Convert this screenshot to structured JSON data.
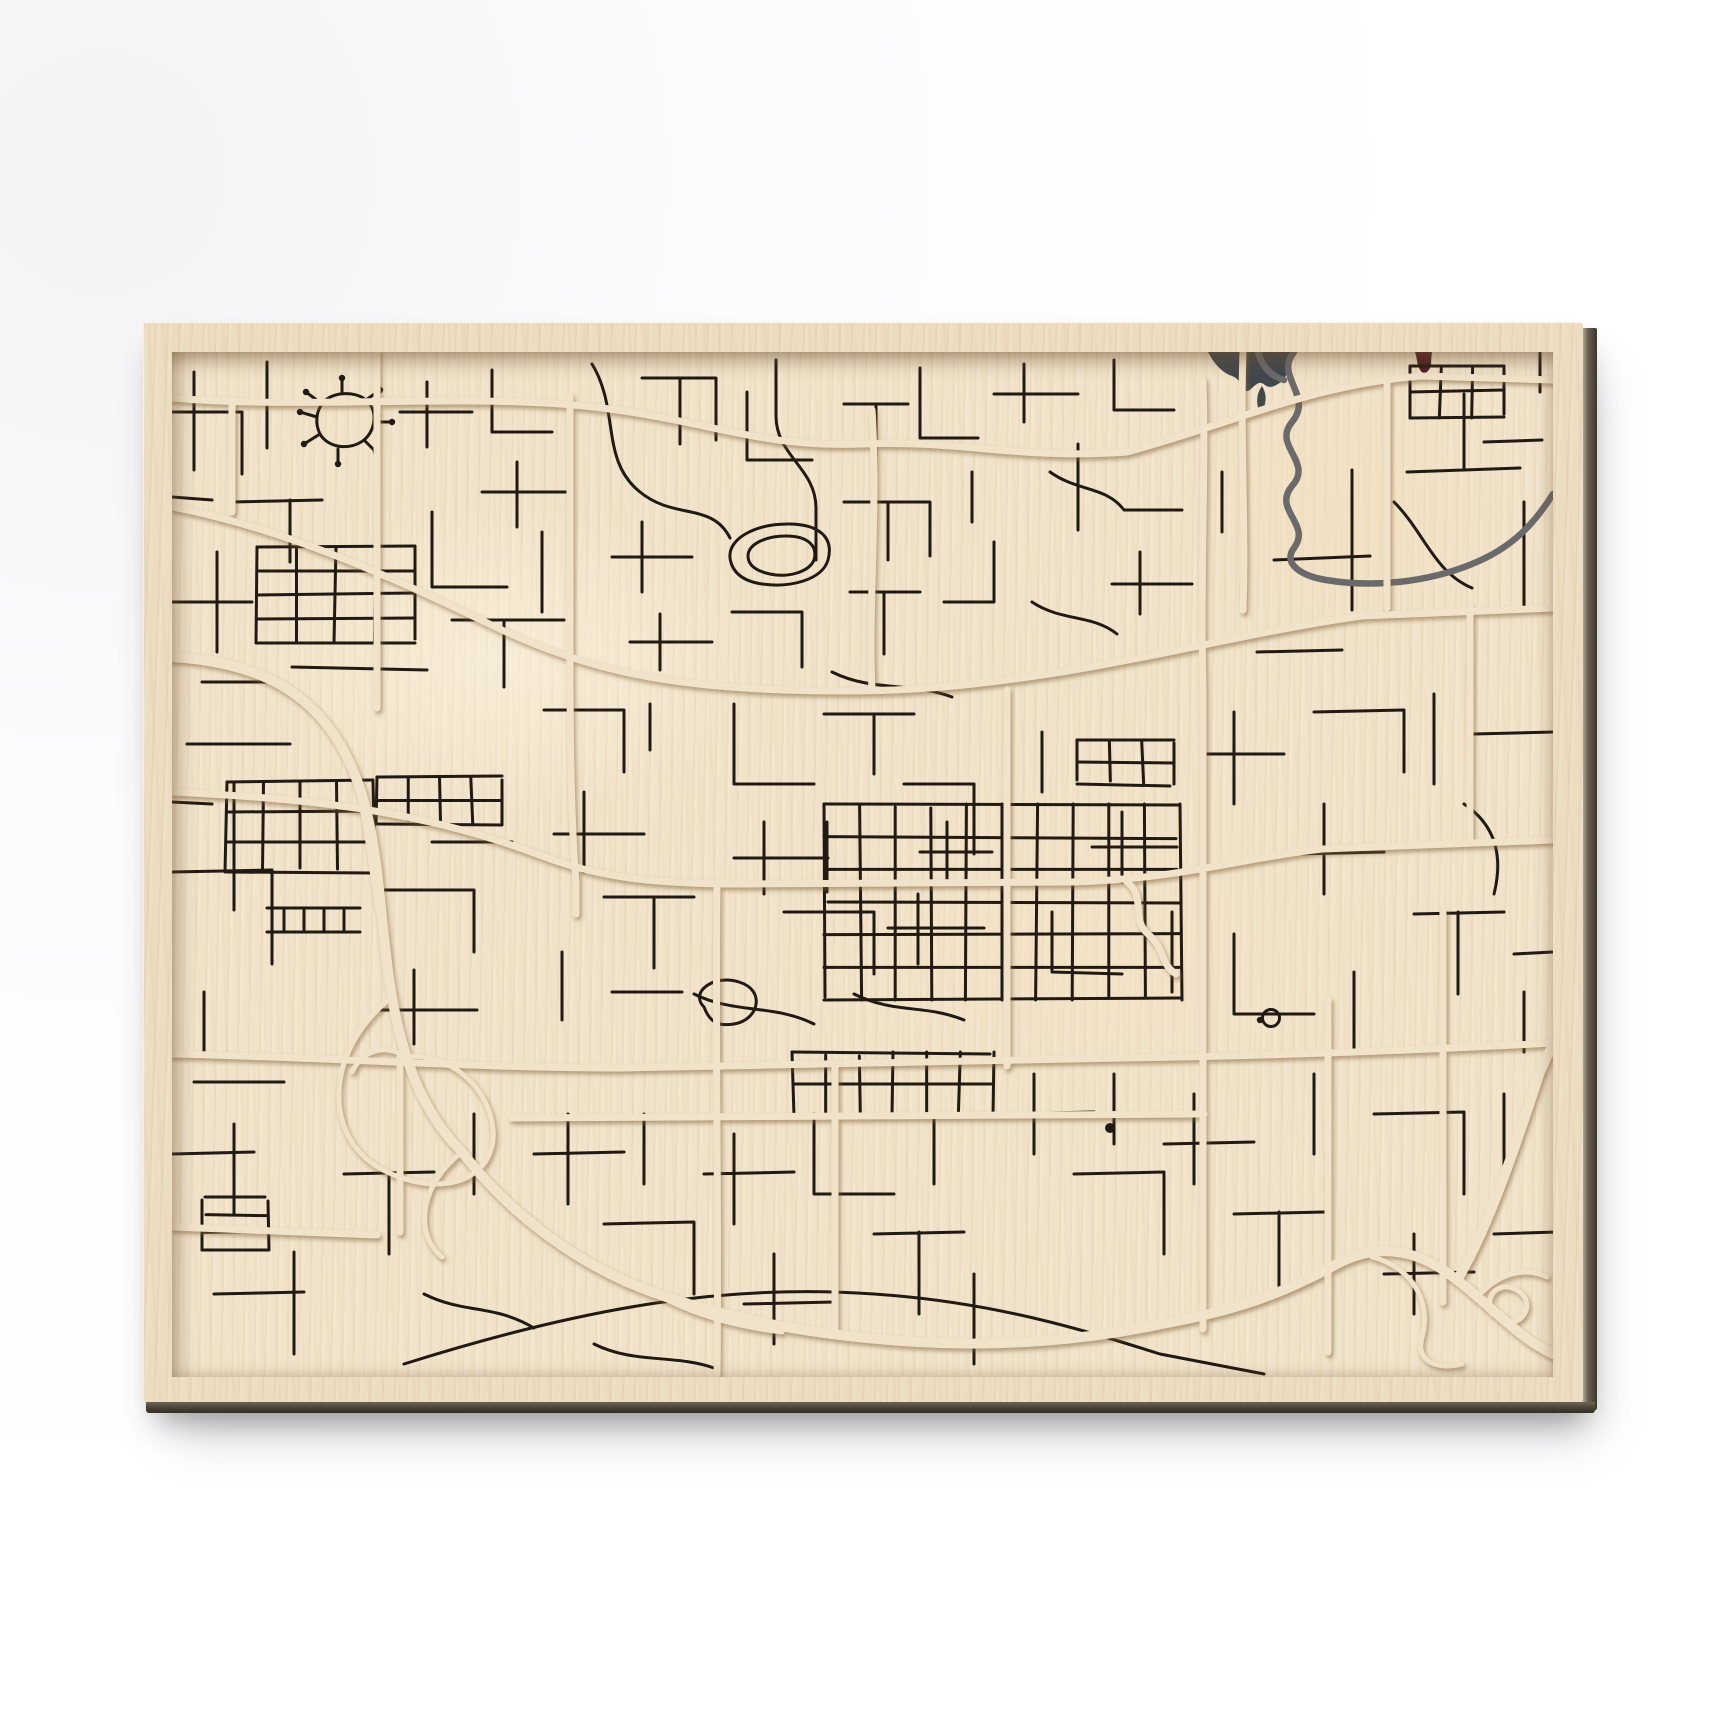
{
  "scene": {
    "background": "#ffffff",
    "description_colors": {
      "wood_face": "#ecdcc0",
      "map_surface": "#f0e3c9",
      "engraving": "#211a12",
      "major_road": "#f0e3c9",
      "river": "#6a6a6a",
      "lake": "#42474d",
      "marker": "#4e1d26",
      "panel_edge_dark": "#3c362c"
    }
  },
  "panel": {
    "left": 143,
    "top": 322,
    "width": 1440,
    "height": 1080,
    "frame_inset": {
      "left": 29,
      "top": 30,
      "right": 30,
      "bottom": 25
    }
  },
  "map": {
    "view_w": 1381,
    "view_h": 1025,
    "stroke_minor": 3,
    "stroke_major": 7,
    "stroke_freeway": 10,
    "stroke_ramp": 5,
    "stroke_river": 6.5,
    "lake": "M1036,0 L1118,0 C1112,14 1120,24 1106,32 C1090,42 1094,22 1080,36 C1070,46 1072,28 1060,24 C1048,20 1040,8 1036,0 Z",
    "lake2": "M1090,34 C1096,44 1094,54 1088,62 C1084,52 1084,42 1090,34 Z",
    "markers": [
      "M1243,0 L1260,0 C1258,10 1262,16 1252,22 C1244,16 1246,8 1243,0 Z"
    ],
    "river": [
      "M1122,0 C1102,24 1142,44 1120,70 C1100,94 1142,110 1120,134 C1100,158 1140,172 1122,196 C1110,212 1130,224 1154,228 C1202,236 1256,230 1300,212 C1340,196 1362,172 1381,142",
      "M1086,0 C1090,14 1098,24 1112,28"
    ],
    "majors": [
      "M0,46 C140,58 300,40 430,56 C540,70 590,96 690,92 C790,88 850,108 955,100 C1060,72 1140,32 1250,24 L1381,28",
      "M0,155 C120,178 230,230 330,278 C420,320 500,334 610,338 C730,342 800,334 890,320 C990,304 1090,278 1190,264 L1381,256",
      "M0,440 C140,447 250,458 370,504 C430,527 490,532 570,532 L900,530 C1010,527 1070,506 1150,497 L1381,488",
      "M0,702 C150,705 300,716 450,716 C650,712 800,708 950,706 C1100,704 1250,698 1381,691",
      "M340,766 L1032,762",
      "M0,875 L205,883",
      "M205,0 L205,356",
      "M60,48 L60,160",
      "M398,44 L398,300 C398,420 400,480 404,532 L404,562",
      "M545,531 C543,700 547,850 545,1025",
      "M663,716 L663,982",
      "M700,58 C706,150 696,260 700,338",
      "M835,338 L835,714",
      "M1031,28 C1034,120 1028,220 1031,338 L1031,716 C1031,830 1031,910 1031,977",
      "M1071,0 C1068,80 1074,180 1071,258",
      "M1156,648 L1156,1000",
      "M1271,560 L1271,950",
      "M1298,256 L1298,488",
      "M1215,26 L1215,256",
      "M228,705 L228,880",
      "M955,530 C975,546 958,566 976,582 C994,598 988,612 1004,622"
    ],
    "freeway": [
      "M0,305 C80,310 140,335 175,405 C210,475 205,560 220,645 C233,718 255,765 290,800",
      "M290,800 C340,865 410,915 480,940 C570,972 660,985 745,990 C830,995 915,988 990,972 C1065,958 1110,942 1165,912 C1210,888 1250,900 1285,928 C1318,953 1345,985 1381,1002",
      "M1285,928 C1315,880 1345,790 1368,720 L1381,692"
    ],
    "ramps": [
      "M220,645 C150,700 150,790 215,820 C280,850 330,820 320,770 C312,728 270,700 235,705",
      "M290,800 C250,830 240,880 270,905",
      "M235,705 C210,690 190,700 180,720",
      "M1200,905 C1240,915 1260,950 1250,985 C1243,1010 1265,1018 1290,1012",
      "M1310,940 C1330,920 1355,915 1375,925",
      "M1320,962 C1310,937 1335,927 1350,942 C1362,954 1350,974 1332,970",
      "M480,940 C520,962 560,974 610,980",
      "M175,405 C195,450 198,520 210,580"
    ],
    "minor": [
      "M22,20 L22,118",
      "M0,60 L70,60 L70,122",
      "M95,10 L95,96",
      "M60,150 L150,148 M118,148 L118,210",
      "M0,145 L40,148",
      "M150,52 C158,40 182,38 194,48 C206,58 204,78 192,88 C178,99 156,96 148,82 C143,72 144,60 150,52",
      "M150,52 L134,40",
      "M194,48 L208,38",
      "M204,70 L220,70",
      "M192,88 L204,100",
      "M166,97 L166,112",
      "M148,82 L132,92",
      "M145,65 L128,60",
      "M170,40 L170,26",
      "M255,30 L255,95 M228,60 L300,60",
      "M320,18 L320,80 L380,80",
      "M345,110 L345,175 M310,140 L395,140",
      "M45,200 L45,300",
      "M0,250 L80,250",
      "M260,160 L260,235 L335,235",
      "M280,268 L392,268 M332,268 L332,335",
      "M120,315 L255,318",
      "M30,330 L110,330",
      "M370,180 L370,260",
      "M420,12 C448,58 428,108 468,140 C502,168 540,150 558,186",
      "M470,26 L544,26 L544,88 M508,26 L508,92",
      "M575,40 L575,108 L640,108",
      "M604,8 L604,64 C604,104 644,116 644,156 L644,208",
      "M672,52 L736,52 M704,52 L704,118",
      "M748,16 L748,86 L806,86",
      "M558,206 C556,186 584,172 616,172 C648,172 662,186 656,208 C650,228 618,236 590,232 C570,229 560,220 558,206",
      "M576,204 C576,192 594,184 614,184 C636,184 646,194 642,208 C637,220 616,226 598,222 C584,219 576,213 576,204",
      "M470,170 L470,240 M440,205 L520,205",
      "M488,262 L488,318 M458,290 L540,290",
      "M672,150 L758,150 L758,204 M716,150 L716,208",
      "M678,240 L748,240 M712,240 L712,302",
      "M772,250 L822,250 L822,190",
      "M560,260 L630,260 L630,315",
      "M660,320 C700,340 740,330 780,345",
      "M800,120 L800,170",
      "M852,12 L852,70 M822,42 L906,42",
      "M878,120 C906,140 934,134 952,158 L1010,158",
      "M906,92 L906,178",
      "M942,8 L942,58 L1002,58",
      "M968,200 L968,262 M940,232 L1020,232",
      "M1180,118 L1180,258",
      "M1102,208 L1198,204",
      "M1235,120 L1348,116 M1292,116 L1292,42",
      "M1352,150 L1352,258 L1282,262",
      "M1085,300 L1170,298",
      "M1222,150 C1252,180 1262,220 1300,236",
      "M1370,88 L1312,90",
      "M1368,40 L1368,0",
      "M860,250 C890,270 920,262 945,282",
      "M1050,120 L1050,180",
      "M15,392 L118,392",
      "M62,430 L62,558",
      "M0,520 L100,518 L100,612",
      "M95,556 L188,556 M95,580 L188,580 M112,556 L112,580 M132,556 L132,580 M152,556 L152,580 M172,556 L172,580",
      "M212,538 L302,538 L302,600",
      "M242,618 L242,692 M205,658 L305,658",
      "M32,640 L32,700",
      "M0,450 L40,452",
      "M260,490 L340,490",
      "M372,358 L452,358 L452,420",
      "M412,440 L412,520 M382,482 L472,482",
      "M432,545 L522,545 M482,545 L482,616",
      "M562,352 L562,432 L642,432",
      "M592,470 L592,542 M562,506 L656,506",
      "M612,560 L702,560 L702,622",
      "M652,362 L742,362 M702,362 L702,422",
      "M732,432 L802,432 L802,502",
      "M746,542 L746,612 M716,576 L812,576",
      "M522,642 C562,662 602,652 642,672",
      "M532,655 C517,640 542,622 567,630 C594,638 587,668 562,672 C544,675 537,668 532,655",
      "M682,642 C722,662 752,652 792,668",
      "M390,600 L390,668",
      "M440,640 L510,640",
      "M478,398 L478,352",
      "M655,470 L655,540",
      "M775,470 L775,530 M748,500 L820,500",
      "M1062,360 L1062,452 M1032,402 L1112,402",
      "M1142,360 L1232,358 L1232,420",
      "M1152,452 L1152,542 M1122,502 L1212,500",
      "M1262,342 L1262,432",
      "M1302,382 L1381,380",
      "M1292,452 C1322,472 1332,502 1322,542",
      "M1242,562 L1332,560 M1286,560 L1286,642",
      "M1062,582 L1062,662 L1142,662",
      "M1182,620 L1182,702",
      "M1342,602 L1381,600",
      "M1352,640 L1352,700",
      "M950,460 L950,530 M920,495 L1005,495",
      "M870,380 L870,440",
      "M880,560 L880,620 L950,622",
      "M1000,560 L1000,640",
      "M22,730 L112,730",
      "M62,772 L62,862",
      "M0,802 L82,800",
      "M122,900 L122,1002",
      "M42,942 L132,940",
      "M172,822 L262,820 M217,820 L217,902",
      "M252,942 C292,962 322,952 362,976",
      "M302,762 L302,842",
      "M396,762 L396,852 M362,802 L452,800",
      "M432,872 L522,870 L522,942",
      "M472,762 L472,832",
      "M562,782 L562,872 M532,822 L622,820",
      "M602,902 L602,992 M572,952 L662,950",
      "M642,762 L642,842 L722,842",
      "M702,882 L792,880 M747,880 L747,962",
      "M762,762 L762,832",
      "M802,922 L802,1012",
      "M422,992 C462,1012 502,1002 542,1016",
      "M232,1012 C422,952 562,932 702,942 C822,950 912,978 988,1002 L1092,1022",
      "M862,722 L862,802 M832,762 L922,760",
      "M902,822 L992,820 L992,902",
      "M942,722 L942,792",
      "M1022,742 L1022,832 M992,792 L1082,790",
      "M1062,862 L1152,860 M1107,860 L1107,942",
      "M1142,722 L1142,802",
      "M1202,762 L1292,760 L1292,842",
      "M1242,882 L1242,962 M1212,922 L1302,920",
      "M1332,742 L1332,832",
      "M1322,882 L1383,880"
    ],
    "grids": [
      {
        "x": 85,
        "y": 195,
        "w": 158,
        "h": 96,
        "rows": 4,
        "cols": 4
      },
      {
        "x": 1238,
        "y": 14,
        "w": 94,
        "h": 52,
        "rows": 2,
        "cols": 3
      },
      {
        "x": 55,
        "y": 430,
        "w": 146,
        "h": 90,
        "rows": 3,
        "cols": 4
      },
      {
        "x": 205,
        "y": 425,
        "w": 125,
        "h": 47,
        "rows": 2,
        "cols": 4
      },
      {
        "x": 905,
        "y": 388,
        "w": 97,
        "h": 44,
        "rows": 2,
        "cols": 3
      },
      {
        "x": 652,
        "y": 452,
        "w": 356,
        "h": 196,
        "rows": 6,
        "cols": 10
      },
      {
        "x": 620,
        "y": 700,
        "w": 202,
        "h": 64,
        "rows": 2,
        "cols": 6
      },
      {
        "x": 30,
        "y": 845,
        "w": 66,
        "h": 53,
        "rows": 3,
        "cols": 1
      }
    ],
    "dots": [
      [
        134,
        40
      ],
      [
        208,
        38
      ],
      [
        220,
        70
      ],
      [
        204,
        100
      ],
      [
        166,
        112
      ],
      [
        132,
        92
      ],
      [
        128,
        60
      ],
      [
        170,
        26
      ],
      [
        1088,
        668
      ]
    ],
    "pond": {
      "cx": 938,
      "cy": 776,
      "r": 5
    },
    "roundabout": {
      "cx": 1099,
      "cy": 666,
      "r": 8.5
    }
  }
}
